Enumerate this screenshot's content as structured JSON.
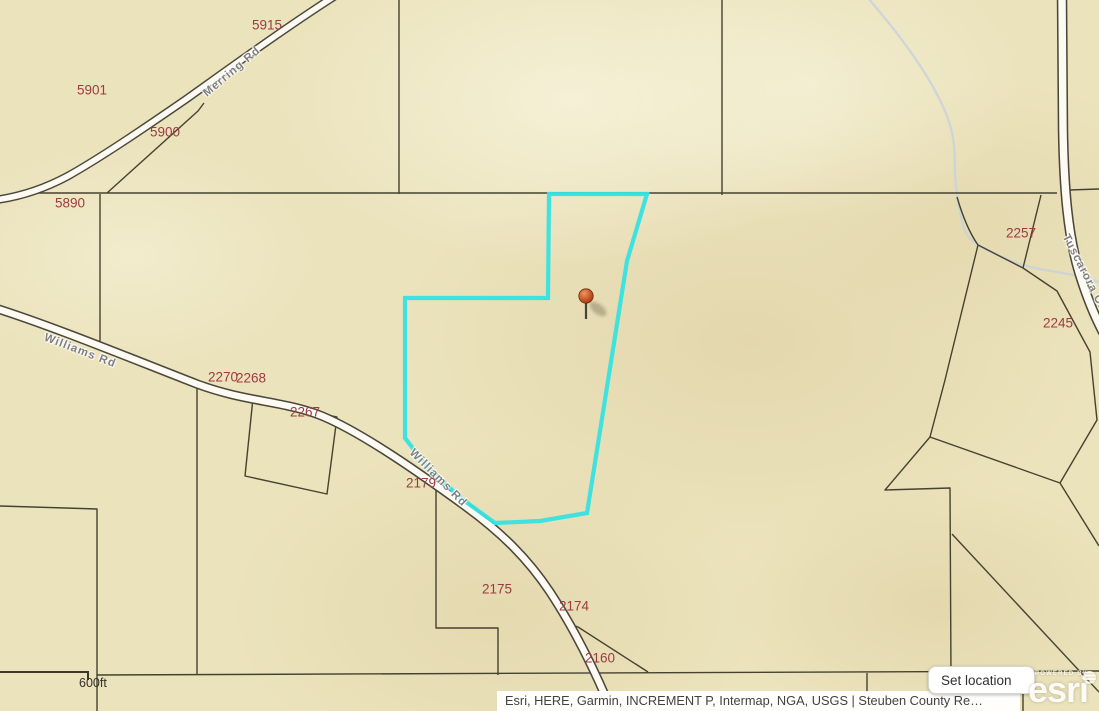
{
  "map": {
    "parcel_labels": [
      {
        "text": "5915",
        "x": 267,
        "y": 25
      },
      {
        "text": "5901",
        "x": 92,
        "y": 90
      },
      {
        "text": "5900",
        "x": 165,
        "y": 132
      },
      {
        "text": "5890",
        "x": 70,
        "y": 203
      },
      {
        "text": "2257",
        "x": 1021,
        "y": 233
      },
      {
        "text": "2245",
        "x": 1058,
        "y": 323
      },
      {
        "text": "2270",
        "x": 223,
        "y": 377
      },
      {
        "text": "2268",
        "x": 251,
        "y": 378
      },
      {
        "text": "2267",
        "x": 305,
        "y": 412
      },
      {
        "text": "2179",
        "x": 421,
        "y": 483
      },
      {
        "text": "2175",
        "x": 497,
        "y": 589
      },
      {
        "text": "2174",
        "x": 574,
        "y": 606
      },
      {
        "text": "2160",
        "x": 600,
        "y": 658
      }
    ],
    "road_labels": [
      {
        "text": "Merring Rd",
        "x": 232,
        "y": 72,
        "angle": -40
      },
      {
        "text": "Williams Rd",
        "x": 80,
        "y": 351,
        "angle": 21
      },
      {
        "text": "Williams Rd",
        "x": 438,
        "y": 478,
        "angle": 45
      },
      {
        "text": "Tuscarora Cr",
        "x": 1084,
        "y": 272,
        "angle": 63
      }
    ],
    "scale_bar_label": "600ft",
    "attribution_text": "Esri, HERE, Garmin, INCREMENT P, Intermap, NGA, USGS | Steuben County Re…",
    "pin": {
      "x": 586,
      "y": 296
    },
    "colors": {
      "highlight": "#36e2e2",
      "parcel_line": "#45422f",
      "parcel_label": "#9c3a42",
      "road_label": "#7f7f7f",
      "creek": "#c9d2da",
      "pin_orange": "#cb5a2d"
    }
  },
  "ui": {
    "set_location_button": "Set location",
    "esri": {
      "powered_by": "POWERED BY",
      "brand": "esri"
    }
  }
}
